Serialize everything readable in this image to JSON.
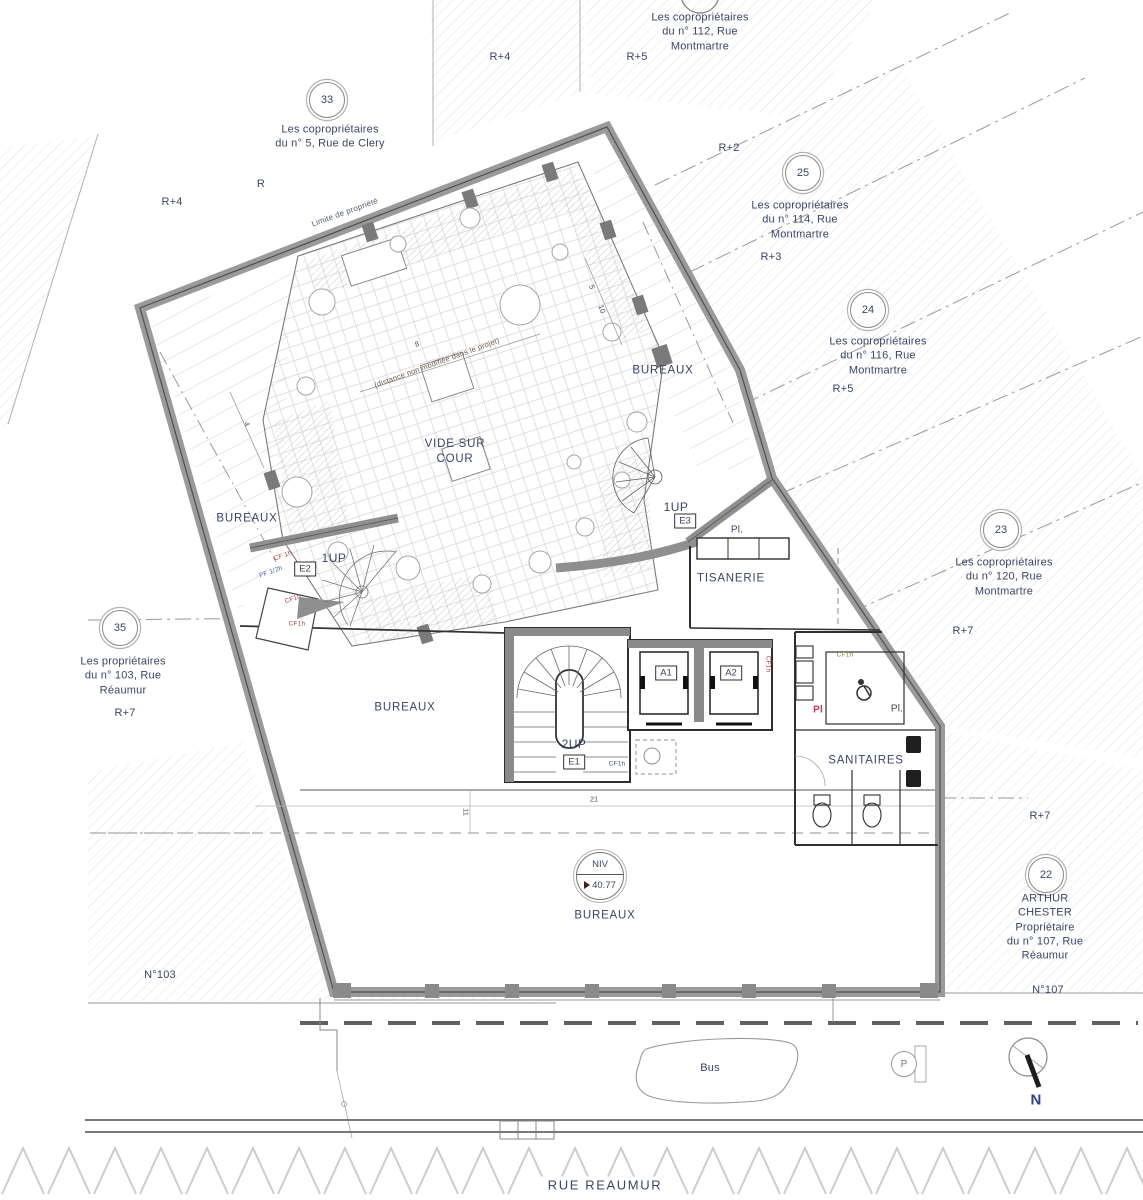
{
  "site": {
    "street_name": "RUE REAUMUR",
    "bus_label": "Bus",
    "parking_label": "P",
    "north_label": "N",
    "n103": "N°103",
    "n107": "N°107",
    "property_line_label": "Limite de propriété",
    "courtyard_note": "(distance non modifiée dans le projet)"
  },
  "owners": {
    "top112": "Les copropriétaires\ndu n° 112, Rue\nMontmartre",
    "b33": {
      "num": "33",
      "text": "Les copropriétaires\ndu n° 5, Rue de Clery"
    },
    "b25": {
      "num": "25",
      "text": "Les copropriétaires\ndu n° 114, Rue\nMontmartre"
    },
    "b24": {
      "num": "24",
      "text": "Les copropriétaires\ndu n° 116, Rue\nMontmartre"
    },
    "b23": {
      "num": "23",
      "text": "Les copropriétaires\ndu n° 120, Rue\nMontmartre"
    },
    "b35": {
      "num": "35",
      "text": "Les propriétaires\ndu n° 103, Rue\nRéaumur"
    },
    "b22": {
      "num": "22",
      "text": "ARTHUR CHESTER\nPropriétaire\ndu n° 107, Rue Réaumur"
    }
  },
  "levels": {
    "top_r4": "R+4",
    "top_r5": "R+5",
    "left_r": "R",
    "left_r4": "R+4",
    "r2": "R+2",
    "r3": "R+3",
    "right_r5": "R+5",
    "right_r7": "R+7",
    "left_r7": "R+7",
    "bottom_r7": "R+7"
  },
  "rooms": {
    "bureaux": "BUREAUX",
    "vide_sur_cour": "VIDE SUR\nCOUR",
    "tisanerie": "TISANERIE",
    "sanitaires": "SANITAIRES"
  },
  "core": {
    "up1": "1UP",
    "up2": "2UP",
    "e1": "E1",
    "e2": "E2",
    "e3": "E3",
    "a1": "A1",
    "a2": "A2",
    "pl_dot": "Pl.",
    "pl": "Pl"
  },
  "level_marker": {
    "label": "NIV",
    "value": "40.77"
  },
  "dimensions": {
    "d4": "4",
    "d5": "5",
    "d10": "10",
    "d8": "8",
    "d21": "21",
    "d11": "11"
  },
  "fire_ratings": {
    "cf_1h": "CF 1h",
    "pf_half": "PF 1/2h",
    "cf1h": "CF1h"
  },
  "colors": {
    "ink": "#3b4468",
    "wall_gray": "#8f8f8f",
    "accent_red": "#c03a30",
    "north_blue": "#2b3f8c"
  }
}
